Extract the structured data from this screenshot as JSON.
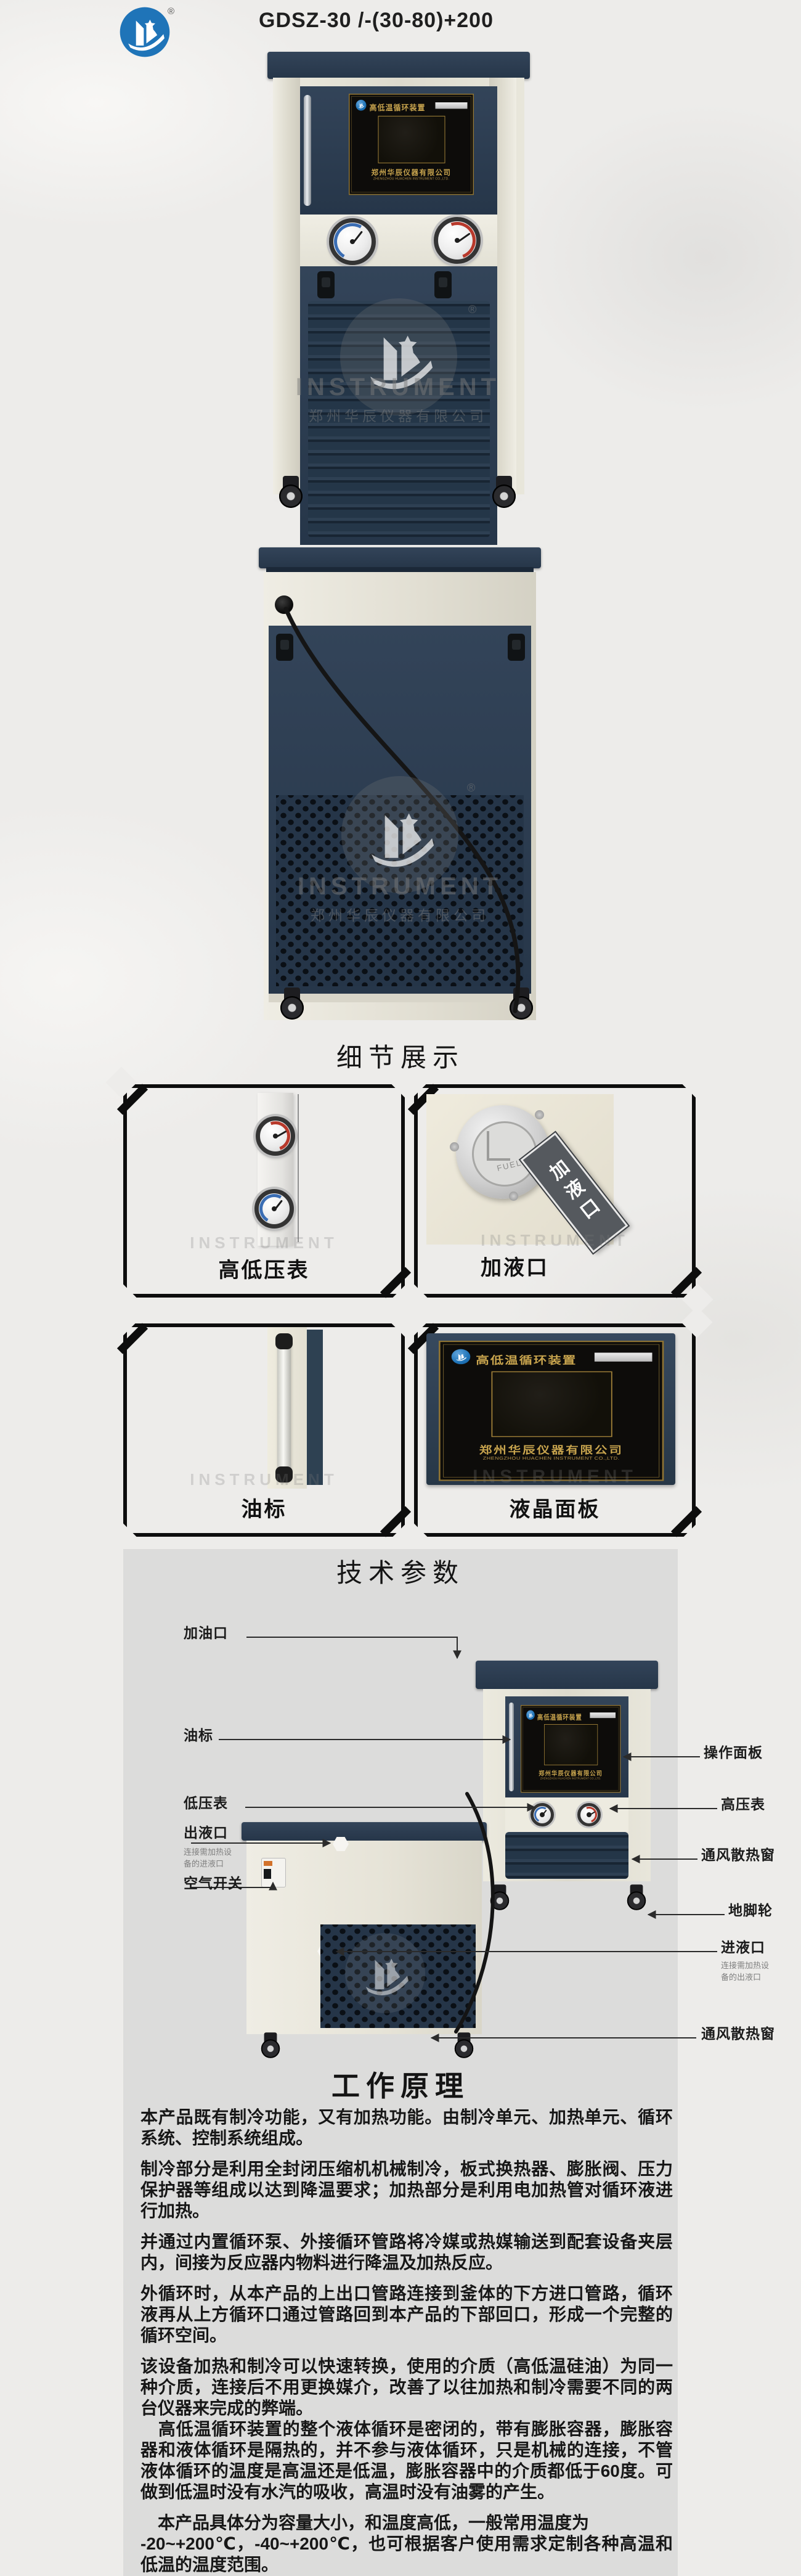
{
  "colors": {
    "logo_blue": "#1f74b8",
    "machine_navy": "#2b3c51",
    "machine_cream": "#e7e4d9",
    "panel_gold": "#c9a54e",
    "content_panel_gray": "#dcdcdb"
  },
  "header": {
    "title": "GDSZ-30 /-(30-80)+200",
    "registered_mark": "®"
  },
  "brand": {
    "watermark_en": "INSTRUMENT",
    "company_cn": "郑州华辰仪器有限公司",
    "company_en": "ZHENGZHOU HUACHEN INSTRUMENT CO.,LTD.",
    "registered_mark": "®"
  },
  "control_panel": {
    "device_name": "高低温循环装置",
    "company_cn": "郑州华辰仪器有限公司",
    "company_en": "ZHENGZHOU HUACHEN INSTRUMENT CO.,LTD."
  },
  "sections": {
    "details": "细节展示",
    "specs": "技术参数",
    "principle": "工作原理"
  },
  "details": {
    "box1_label": "高低压表",
    "box2_label": "加液口",
    "box2_plate_text": "加液口",
    "box2_cap_text": "FUEL",
    "box3_label": "油标",
    "box4_label": "液晶面板"
  },
  "diagram": {
    "left": [
      {
        "label": "加油口"
      },
      {
        "label": "油标"
      },
      {
        "label": "低压表"
      },
      {
        "label": "出液口",
        "note": "连接需加热设\n备的进液口"
      },
      {
        "label": "空气开关"
      }
    ],
    "right": [
      {
        "label": "操作面板"
      },
      {
        "label": "高压表"
      },
      {
        "label": "通风散热窗"
      },
      {
        "label": "地脚轮"
      },
      {
        "label": "进液口",
        "note": "连接需加热设\n备的出液口"
      },
      {
        "label": "通风散热窗"
      }
    ]
  },
  "principle": {
    "paragraphs": [
      "本产品既有制冷功能，又有加热功能。由制冷单元、加热单元、循环系统、控制系统组成。",
      "制冷部分是利用全封闭压缩机机械制冷，板式换热器、膨胀阀、压力保护器等组成以达到降温要求；加热部分是利用电加热管对循环液进行加热。",
      "并通过内置循环泵、外接循环管路将冷媒或热媒输送到配套设备夹层内，间接为反应器内物料进行降温及加热反应。",
      "外循环时，从本产品的上出口管路连接到釜体的下方进口管路，循环液再从上方循环口通过管路回到本产品的下部回口，形成一个完整的循环空间。",
      "该设备加热和制冷可以快速转换，使用的介质（高低温硅油）为同一种介质，连接后不用更换媒介，改善了以往加热和制冷需要不同的两台仪器来完成的弊端。",
      "　高低温循环装置的整个液体循环是密闭的，带有膨胀容器，膨胀容器和液体循环是隔热的，并不参与液体循环，只是机械的连接，不管液体循环的温度是高温还是低温，膨胀容器中的介质都低于60度。可做到低温时没有水汽的吸收，高温时没有油雾的产生。",
      "　本产品具体分为容量大小，和温度高低，一般常用温度为\n-20~+200℃，-40~+200℃，也可根据客户使用需求定制各种高温和低温的温度范围。"
    ]
  }
}
